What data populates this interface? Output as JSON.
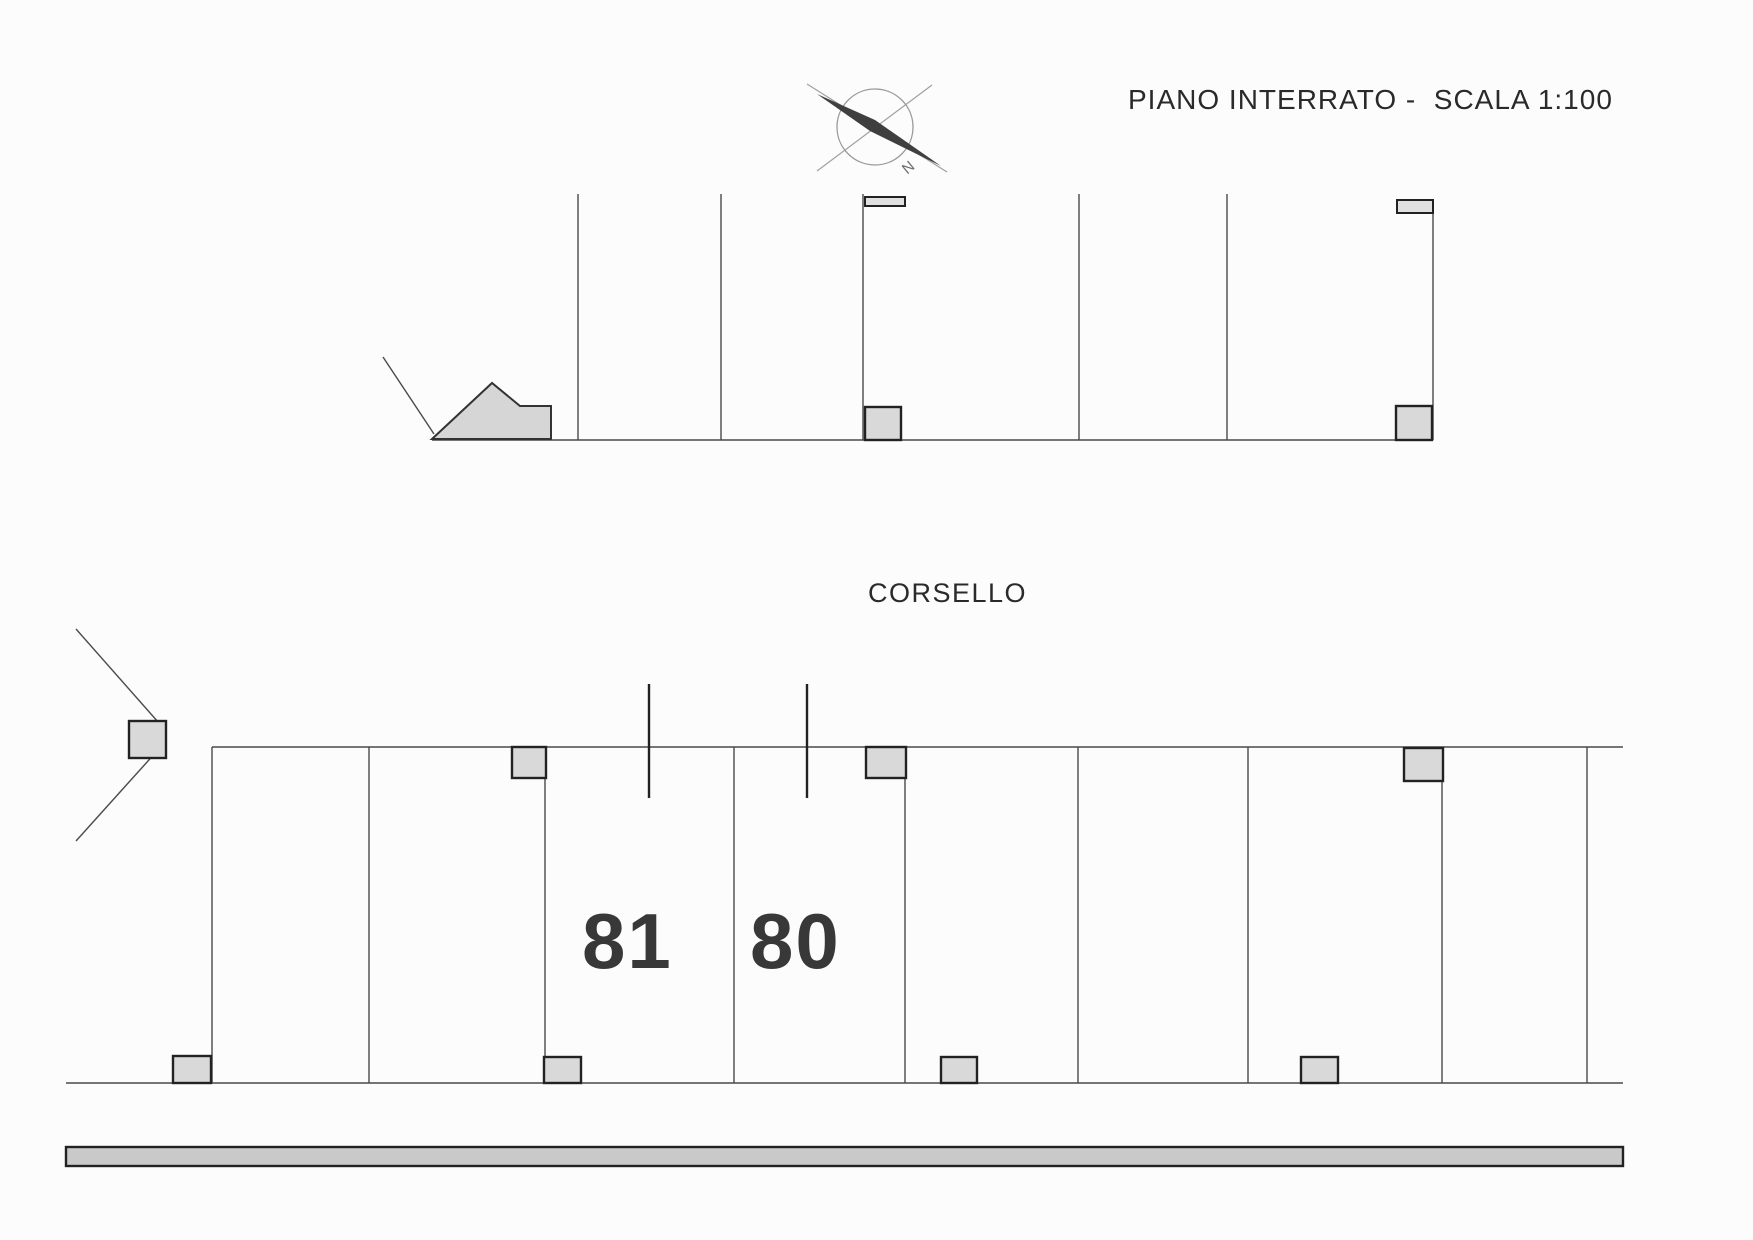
{
  "plan": {
    "title": "PIANO INTERRATO -  SCALA 1:100",
    "corridor_label": "CORSELLO",
    "compass_n": "N",
    "stalls": [
      {
        "number": "81"
      },
      {
        "number": "80"
      }
    ]
  },
  "colors": {
    "paper": "#fcfcfc",
    "line_thin": "#4a4a4a",
    "line_heavy": "#222222",
    "pillar_fill": "#d9d9d9",
    "road_bar_fill": "#c9c9c9",
    "text": "#2a2a2a"
  }
}
